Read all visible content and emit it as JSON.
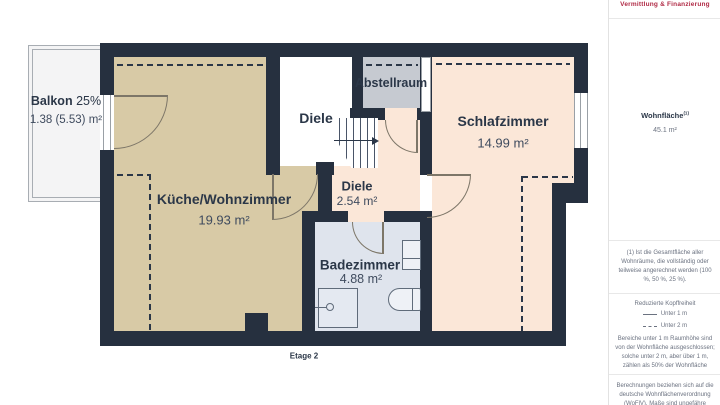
{
  "logo": "Vermittlung & Finanzierung",
  "floor_label": "Etage 2",
  "rooms": {
    "balkon": {
      "name": "Balkon",
      "share": "25%",
      "area": "1.38 (5.53) m²"
    },
    "kueche": {
      "name": "Küche/Wohnzimmer",
      "area": "19.93 m²"
    },
    "diele_og": {
      "name": "Diele"
    },
    "abstellraum": {
      "name": "Abstellraum"
    },
    "schlafzimmer": {
      "name": "Schlafzimmer",
      "area": "14.99 m²"
    },
    "diele": {
      "name": "Diele",
      "area": "2.54 m²"
    },
    "badezimmer": {
      "name": "Badezimmer",
      "area": "4.88 m²"
    }
  },
  "sidebar": {
    "wohnflaeche": {
      "label": "Wohnfläche",
      "sup": "(1)",
      "value": "45.1 m²"
    },
    "footnote": "(1) Ist die Gesamtfläche aller Wohnräume, die vollständig oder teilweise angerechnet werden (100 %, 50 %, 25 %).",
    "kopffreiheit_title": "Reduzierte Kopffreiheit",
    "legend": [
      {
        "style": "dash",
        "label": "Unter 1 m"
      },
      {
        "style": "dot",
        "label": "Unter 2 m"
      }
    ],
    "kopffreiheit_note": "Bereiche unter 1 m Raumhöhe sind von der Wohnfläche ausgeschlossen; solche unter 2 m, aber über 1 m, zählen als 50% der Wohnfläche",
    "disclaimer": "Berechnungen beziehen sich auf die deutsche Wohnflächenverordnung (WoFlV). Maße sind ungefähre Angaben"
  },
  "colors": {
    "wall": "#26303f",
    "kueche": "#d8caa6",
    "peach": "#fbe7d8",
    "abstell": "#c6cad1",
    "bad": "#dfe4ed",
    "balkon": "#f4f4f5",
    "label": "#2b3748",
    "accent": "#b02a45",
    "door": "#7d7668"
  }
}
